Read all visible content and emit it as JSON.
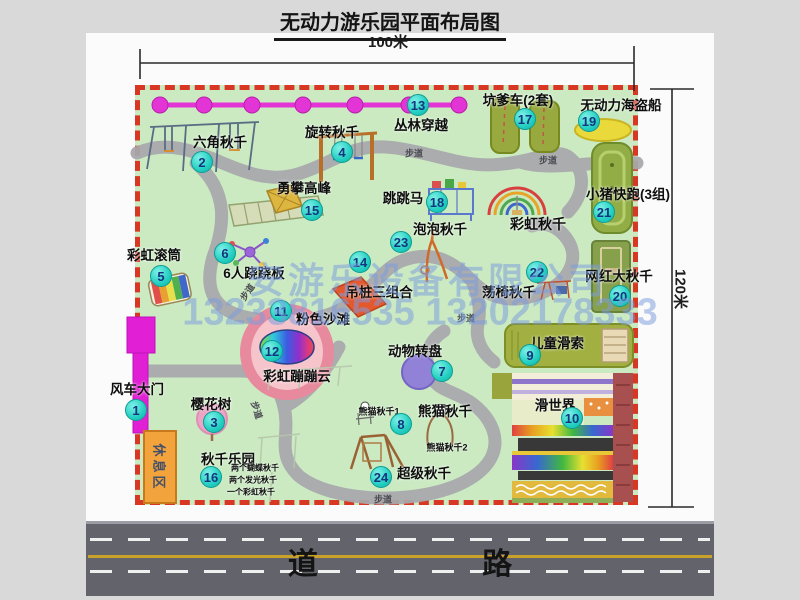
{
  "title": "无动力游乐园平面布局图",
  "dimensions": {
    "top": "100米",
    "right": "120米"
  },
  "watermark": {
    "company": "安游乐设备有限公司",
    "phone": "13233816535 13202178333"
  },
  "road_label": "道 路",
  "rest_area_label": "休息区",
  "colors": {
    "map_bg": "#cbeac2",
    "map_border": "#d73723",
    "badge": "#23cfc2",
    "badge_text": "#14357f",
    "chain": "#e334d6",
    "road": "#63636b",
    "rest_area": "#f2a33c"
  },
  "map": {
    "markers": [
      {
        "num": "1",
        "label": "风车大门",
        "bx": 136,
        "by": 410,
        "lx": 137,
        "ly": 388
      },
      {
        "num": "2",
        "label": "六角秋千",
        "bx": 202,
        "by": 162,
        "lx": 220,
        "ly": 141
      },
      {
        "num": "3",
        "label": "樱花树",
        "bx": 214,
        "by": 422,
        "lx": 211,
        "ly": 403
      },
      {
        "num": "4",
        "label": "旋转秋千",
        "bx": 342,
        "by": 152,
        "lx": 332,
        "ly": 131
      },
      {
        "num": "5",
        "label": "彩虹滚筒",
        "bx": 161,
        "by": 276,
        "lx": 154,
        "ly": 254
      },
      {
        "num": "6",
        "label": "6人跷跷板",
        "bx": 225,
        "by": 253,
        "lx": 254,
        "ly": 272
      },
      {
        "num": "7",
        "label": "动物转盘",
        "bx": 442,
        "by": 371,
        "lx": 415,
        "ly": 350
      },
      {
        "num": "8",
        "label": "熊猫秋千",
        "bx": 401,
        "by": 424,
        "lx": 445,
        "ly": 410
      },
      {
        "num": "9",
        "label": "儿童滑索",
        "bx": 530,
        "by": 355,
        "lx": 557,
        "ly": 342
      },
      {
        "num": "10",
        "label": "滑世界",
        "bx": 572,
        "by": 418,
        "lx": 555,
        "ly": 404
      },
      {
        "num": "11",
        "label": "粉色沙滩",
        "bx": 281,
        "by": 311,
        "lx": 323,
        "ly": 318
      },
      {
        "num": "12",
        "label": "彩虹蹦蹦云",
        "bx": 272,
        "by": 351,
        "lx": 297,
        "ly": 375
      },
      {
        "num": "13",
        "label": "丛林穿越",
        "bx": 418,
        "by": 105,
        "lx": 421,
        "ly": 124
      },
      {
        "num": "14",
        "label": "吊桩三组合",
        "bx": 360,
        "by": 262,
        "lx": 379,
        "ly": 291
      },
      {
        "num": "15",
        "label": "勇攀高峰",
        "bx": 312,
        "by": 210,
        "lx": 304,
        "ly": 187
      },
      {
        "num": "16",
        "label": "秋千乐园",
        "bx": 211,
        "by": 477,
        "lx": 228,
        "ly": 458
      },
      {
        "num": "17",
        "label": "坑爹车(2套)",
        "bx": 525,
        "by": 119,
        "lx": 518,
        "ly": 99
      },
      {
        "num": "18",
        "label": "跳跳马",
        "bx": 437,
        "by": 202,
        "lx": 403,
        "ly": 197
      },
      {
        "num": "19",
        "label": "无动力海盗船",
        "bx": 589,
        "by": 121,
        "lx": 621,
        "ly": 104
      },
      {
        "num": "20",
        "label": "网红大秋千",
        "bx": 620,
        "by": 296,
        "lx": 619,
        "ly": 275
      },
      {
        "num": "21",
        "label": "小猪快跑(3组)",
        "bx": 604,
        "by": 212,
        "lx": 628,
        "ly": 193
      },
      {
        "num": "22",
        "label": "荡椅秋千",
        "bx": 537,
        "by": 272,
        "lx": 509,
        "ly": 291
      },
      {
        "num": "23",
        "label": "泡泡秋千",
        "bx": 401,
        "by": 242,
        "lx": 440,
        "ly": 228
      },
      {
        "num": "24",
        "label": "超级秋千",
        "bx": 381,
        "by": 477,
        "lx": 424,
        "ly": 472
      }
    ],
    "area_labels": [
      {
        "text": "彩虹秋千",
        "x": 538,
        "y": 224,
        "size": 14
      },
      {
        "text": "熊猫秋千1",
        "x": 379,
        "y": 411,
        "size": 9
      },
      {
        "text": "熊猫秋千2",
        "x": 447,
        "y": 447,
        "size": 9
      },
      {
        "text": "两个蝴蝶秋千",
        "x": 255,
        "y": 468,
        "size": 8
      },
      {
        "text": "两个发光秋千",
        "x": 253,
        "y": 480,
        "size": 8
      },
      {
        "text": "一个彩虹秋千",
        "x": 251,
        "y": 492,
        "size": 8
      }
    ],
    "path_labels": [
      {
        "text": "步道",
        "x": 247,
        "y": 292,
        "rot": -55
      },
      {
        "text": "步道",
        "x": 414,
        "y": 153,
        "rot": 0
      },
      {
        "text": "步道",
        "x": 548,
        "y": 160,
        "rot": 0
      },
      {
        "text": "步道",
        "x": 466,
        "y": 318,
        "rot": 0
      },
      {
        "text": "步道",
        "x": 257,
        "y": 410,
        "rot": 72
      },
      {
        "text": "步道",
        "x": 383,
        "y": 499,
        "rot": 0
      }
    ]
  }
}
